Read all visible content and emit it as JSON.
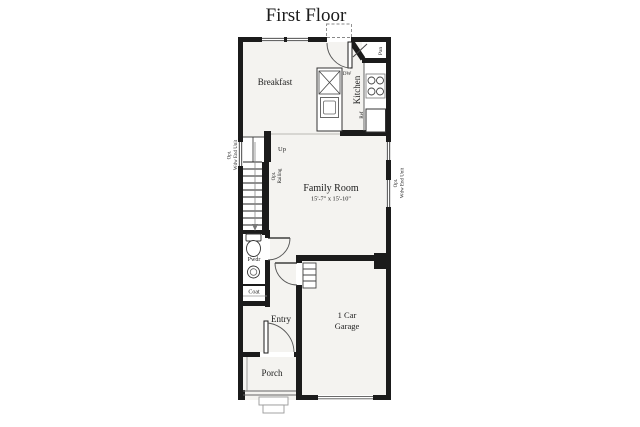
{
  "title": "First Floor",
  "rooms": {
    "breakfast": {
      "label": "Breakfast"
    },
    "kitchen": {
      "label": "Kitchen"
    },
    "pantry": {
      "label": "Pan"
    },
    "family_room": {
      "label": "Family Room",
      "dimensions": "15'-7\" x 15'-10\""
    },
    "powder": {
      "label": "Pwdr"
    },
    "coat": {
      "label": "Coat"
    },
    "entry": {
      "label": "Entry"
    },
    "porch": {
      "label": "Porch"
    },
    "garage": {
      "label_line1": "1 Car",
      "label_line2": "Garage"
    }
  },
  "annotations": {
    "up": "Up",
    "dishwasher": "DW",
    "refrigerator": "Ref",
    "opt_railing": {
      "line1": "Opt.",
      "line2": "Railing"
    },
    "opt_window_left": {
      "line1": "Opt.",
      "line2": "Wdw End Unit"
    },
    "opt_window_right": {
      "line1": "Opt.",
      "line2": "Wdw End Unit"
    }
  },
  "colors": {
    "wall": "#1b1b1b",
    "floor_fill": "#f4f3f0",
    "background": "#ffffff",
    "text": "#1b1b1b"
  }
}
